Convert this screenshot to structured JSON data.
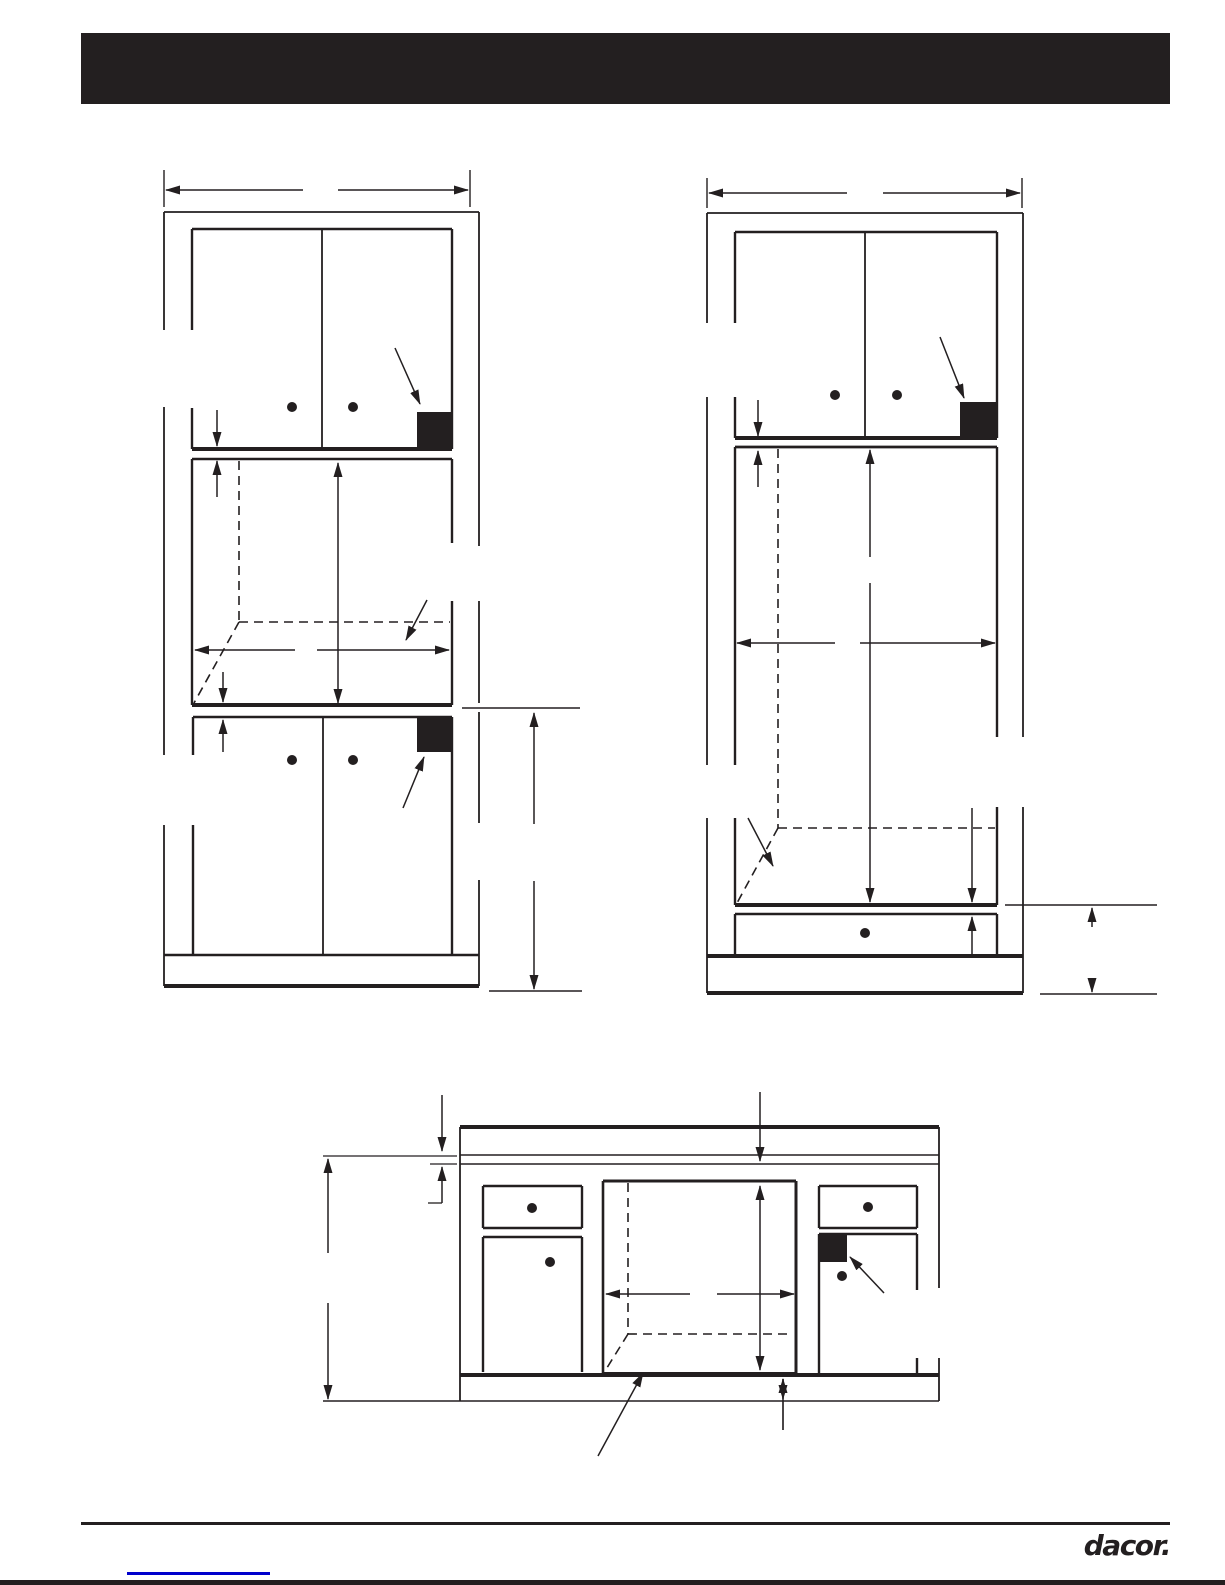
{
  "page": {
    "bg": "#ffffff",
    "ink": "#231f20"
  },
  "header": {
    "bg": "#231f20"
  },
  "footer": {
    "brand": "dacor.",
    "rule_color": "#231f20",
    "link_color": "#0000cc",
    "bottom_bar_color": "#231f20"
  },
  "drawing": {
    "stroke": "#231f20",
    "dot_radius": 5,
    "dash_pattern": "9 6",
    "diagrams": [
      {
        "name": "tall-cabinet-cutout-diagram-left",
        "lines": [
          [
            164,
            170,
            164,
            207,
            1.4
          ],
          [
            470,
            170,
            470,
            207,
            1.4
          ],
          [
            164,
            212,
            479,
            212,
            1.8
          ],
          [
            164,
            212,
            164,
            330,
            1.8
          ],
          [
            164,
            407,
            164,
            755,
            1.8
          ],
          [
            164,
            825,
            164,
            986,
            1.8
          ],
          [
            479,
            212,
            479,
            546,
            1.8
          ],
          [
            479,
            601,
            479,
            703,
            1.8
          ],
          [
            479,
            712,
            479,
            823,
            1.8
          ],
          [
            479,
            880,
            479,
            986,
            1.8
          ],
          [
            192,
            229,
            452,
            229,
            2.4
          ],
          [
            192,
            229,
            192,
            330,
            2.4
          ],
          [
            192,
            408,
            192,
            449,
            2.4
          ],
          [
            452,
            229,
            452,
            449,
            2.4
          ],
          [
            192,
            449,
            452,
            449,
            4
          ],
          [
            322,
            229,
            322,
            449,
            1.8
          ],
          [
            192,
            459,
            452,
            459,
            2.4
          ],
          [
            192,
            459,
            192,
            705,
            2.4
          ],
          [
            452,
            459,
            452,
            543,
            2.4
          ],
          [
            452,
            601,
            452,
            705,
            2.4
          ],
          [
            192,
            705,
            452,
            705,
            4
          ],
          [
            193,
            717,
            452,
            717,
            2.4
          ],
          [
            193,
            717,
            193,
            755,
            2.4
          ],
          [
            193,
            825,
            193,
            955,
            2.4
          ],
          [
            452,
            717,
            452,
            955,
            2.4
          ],
          [
            323,
            717,
            323,
            955,
            1.8
          ],
          [
            164,
            955,
            479,
            955,
            2.4
          ],
          [
            164,
            986,
            479,
            986,
            4
          ],
          [
            462,
            708,
            580,
            708,
            1.4
          ],
          [
            489,
            991,
            582,
            991,
            1.4
          ]
        ],
        "dashes": [
          [
            239,
            461,
            239,
            622
          ],
          [
            239,
            622,
            450,
            622
          ],
          [
            239,
            622,
            194,
            703
          ]
        ],
        "arrows": [
          [
            303,
            190,
            166,
            190,
            "e"
          ],
          [
            338,
            190,
            468,
            190,
            "e"
          ],
          [
            395,
            348,
            420,
            404,
            "e"
          ],
          [
            217,
            410,
            217,
            446,
            "e"
          ],
          [
            217,
            497,
            217,
            461,
            "e"
          ],
          [
            338,
            463,
            338,
            703,
            "b"
          ],
          [
            295,
            650,
            195,
            650,
            "e"
          ],
          [
            317,
            650,
            449,
            650,
            "e"
          ],
          [
            427,
            600,
            406,
            640,
            "e"
          ],
          [
            223,
            672,
            223,
            702,
            "e"
          ],
          [
            223,
            752,
            223,
            720,
            "e"
          ],
          [
            403,
            808,
            424,
            757,
            "e"
          ],
          [
            534,
            824,
            534,
            713,
            "e"
          ],
          [
            534,
            881,
            534,
            989,
            "e"
          ]
        ],
        "dots": [
          [
            292,
            407
          ],
          [
            353,
            407
          ],
          [
            292,
            760
          ],
          [
            353,
            760
          ]
        ],
        "filled": [
          [
            417,
            412,
            35,
            37
          ],
          [
            417,
            717,
            35,
            35
          ]
        ]
      },
      {
        "name": "tall-cabinet-cutout-diagram-right",
        "lines": [
          [
            707,
            178,
            707,
            208,
            1.4
          ],
          [
            1022,
            178,
            1022,
            208,
            1.4
          ],
          [
            707,
            213,
            1023,
            213,
            1.8
          ],
          [
            707,
            213,
            707,
            323,
            1.8
          ],
          [
            707,
            397,
            707,
            765,
            1.8
          ],
          [
            707,
            818,
            707,
            993,
            1.8
          ],
          [
            1023,
            213,
            1023,
            737,
            1.8
          ],
          [
            1023,
            807,
            1023,
            993,
            1.8
          ],
          [
            735,
            232,
            997,
            232,
            2.4
          ],
          [
            735,
            232,
            735,
            323,
            2.4
          ],
          [
            735,
            397,
            735,
            438,
            2.4
          ],
          [
            997,
            232,
            997,
            438,
            2.4
          ],
          [
            735,
            438,
            997,
            438,
            4
          ],
          [
            865,
            232,
            865,
            438,
            1.8
          ],
          [
            735,
            447,
            997,
            447,
            2.8
          ],
          [
            735,
            447,
            735,
            765,
            2.4
          ],
          [
            735,
            818,
            735,
            905,
            2.4
          ],
          [
            997,
            447,
            997,
            737,
            2.4
          ],
          [
            997,
            807,
            997,
            905,
            2.4
          ],
          [
            735,
            905,
            997,
            905,
            4
          ],
          [
            735,
            914,
            997,
            914,
            2.4
          ],
          [
            735,
            914,
            735,
            956,
            2.4
          ],
          [
            997,
            914,
            997,
            956,
            2.4
          ],
          [
            707,
            956,
            1023,
            956,
            4
          ],
          [
            707,
            993,
            1023,
            993,
            4
          ],
          [
            1005,
            905,
            1157,
            905,
            1.4
          ],
          [
            1040,
            994,
            1157,
            994,
            1.4
          ]
        ],
        "dashes": [
          [
            778,
            449,
            778,
            828
          ],
          [
            778,
            828,
            995,
            828
          ],
          [
            778,
            828,
            737,
            903
          ]
        ],
        "arrows": [
          [
            847,
            193,
            709,
            193,
            "e"
          ],
          [
            883,
            193,
            1020,
            193,
            "e"
          ],
          [
            940,
            337,
            964,
            398,
            "e"
          ],
          [
            758,
            400,
            758,
            436,
            "e"
          ],
          [
            758,
            487,
            758,
            451,
            "e"
          ],
          [
            870,
            557,
            870,
            450,
            "e"
          ],
          [
            870,
            583,
            870,
            902,
            "e"
          ],
          [
            835,
            643,
            737,
            643,
            "e"
          ],
          [
            860,
            643,
            995,
            643,
            "e"
          ],
          [
            748,
            818,
            773,
            866,
            "e"
          ],
          [
            972,
            808,
            972,
            902,
            "e"
          ],
          [
            972,
            955,
            972,
            917,
            "e"
          ],
          [
            1092,
            927,
            1092,
            908,
            "e"
          ],
          [
            1092,
            978,
            1092,
            992,
            "e"
          ]
        ],
        "dots": [
          [
            835,
            395
          ],
          [
            897,
            395
          ],
          [
            865,
            933
          ]
        ],
        "filled": [
          [
            960,
            402,
            37,
            36
          ]
        ]
      },
      {
        "name": "base-cabinet-cutout-diagram-bottom",
        "lines": [
          [
            460,
            1127,
            939,
            1127,
            4
          ],
          [
            460,
            1155,
            939,
            1155,
            1.5
          ],
          [
            460,
            1164,
            939,
            1164,
            1.5
          ],
          [
            460,
            1127,
            460,
            1401,
            1.8
          ],
          [
            939,
            1127,
            939,
            1288,
            1.8
          ],
          [
            939,
            1358,
            939,
            1401,
            1.8
          ],
          [
            460,
            1375,
            939,
            1375,
            4
          ],
          [
            323,
            1401,
            939,
            1401,
            1.4
          ],
          [
            483,
            1186,
            582,
            1186,
            2.4
          ],
          [
            483,
            1186,
            483,
            1228,
            2.4
          ],
          [
            582,
            1186,
            582,
            1228,
            2.4
          ],
          [
            483,
            1228,
            582,
            1228,
            2.4
          ],
          [
            483,
            1237,
            582,
            1237,
            2.4
          ],
          [
            483,
            1237,
            483,
            1372,
            2.4
          ],
          [
            582,
            1237,
            582,
            1372,
            2.4
          ],
          [
            603,
            1181,
            796,
            1181,
            3
          ],
          [
            603,
            1181,
            603,
            1373,
            2.6
          ],
          [
            796,
            1181,
            796,
            1373,
            3
          ],
          [
            603,
            1373,
            796,
            1373,
            2
          ],
          [
            819,
            1186,
            917,
            1186,
            2.4
          ],
          [
            819,
            1186,
            819,
            1228,
            2.4
          ],
          [
            917,
            1186,
            917,
            1228,
            2.4
          ],
          [
            819,
            1228,
            917,
            1228,
            2.4
          ],
          [
            819,
            1234,
            917,
            1234,
            2.4
          ],
          [
            819,
            1234,
            819,
            1373,
            2.4
          ],
          [
            917,
            1234,
            917,
            1290,
            2.4
          ],
          [
            917,
            1358,
            917,
            1373,
            2.4
          ],
          [
            323,
            1156,
            457,
            1156,
            1.3
          ],
          [
            430,
            1164,
            457,
            1164,
            1.3
          ],
          [
            428,
            1203,
            442,
            1203,
            1.3
          ],
          [
            783,
            1400,
            783,
            1430,
            1.3
          ]
        ],
        "dashes": [
          [
            628,
            1183,
            628,
            1334
          ],
          [
            628,
            1334,
            793,
            1334
          ],
          [
            628,
            1334,
            605,
            1371
          ]
        ],
        "arrows": [
          [
            442,
            1095,
            442,
            1151,
            "e"
          ],
          [
            442,
            1203,
            442,
            1167,
            "e"
          ],
          [
            760,
            1092,
            760,
            1161,
            "e"
          ],
          [
            760,
            1186,
            760,
            1370,
            "b"
          ],
          [
            690,
            1294,
            606,
            1294,
            "e"
          ],
          [
            717,
            1294,
            794,
            1294,
            "e"
          ],
          [
            598,
            1456,
            643,
            1373,
            "e"
          ],
          [
            884,
            1293,
            850,
            1257,
            "e"
          ],
          [
            328,
            1253,
            328,
            1159,
            "e"
          ],
          [
            328,
            1303,
            328,
            1399,
            "e"
          ],
          [
            783,
            1430,
            783,
            1379,
            "e"
          ],
          [
            783,
            1379,
            783,
            1399,
            "e"
          ]
        ],
        "dots": [
          [
            532,
            1208
          ],
          [
            550,
            1262
          ],
          [
            868,
            1207
          ],
          [
            842,
            1276
          ]
        ],
        "filled": [
          [
            820,
            1234,
            27,
            28
          ]
        ]
      }
    ]
  }
}
